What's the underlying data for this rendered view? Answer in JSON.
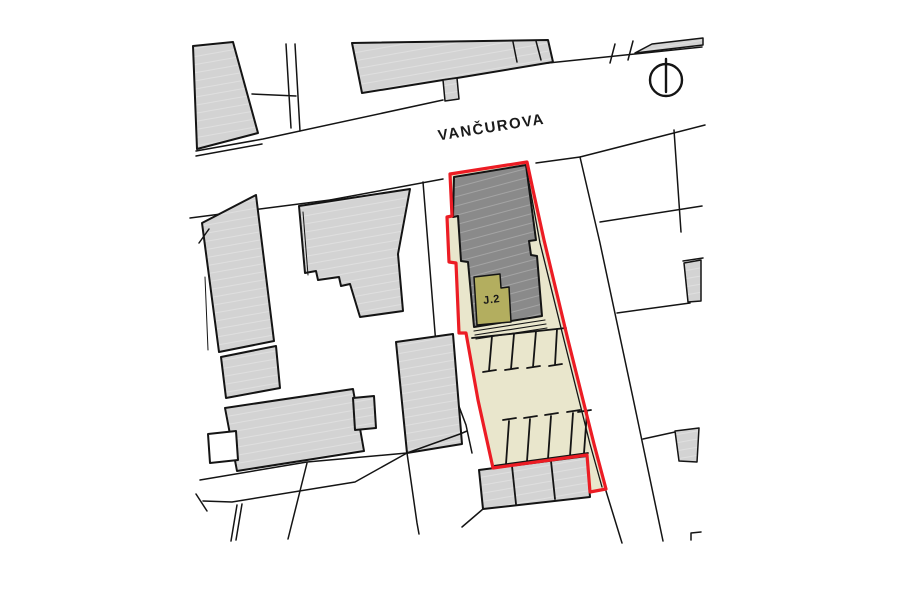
{
  "map": {
    "street_label": "VANČUROVA",
    "unit_label": "J.2"
  },
  "icons": {
    "north_arrow": "north-arrow-icon"
  },
  "colors": {
    "background": "#ffffff",
    "building_light": "#d3d3d3",
    "building_dark": "#8a8a8a",
    "unit_olive": "#b3ae5f",
    "courtyard_cream": "#e9e6cc",
    "boundary_red": "#ec1c24",
    "line_black": "#141414"
  }
}
